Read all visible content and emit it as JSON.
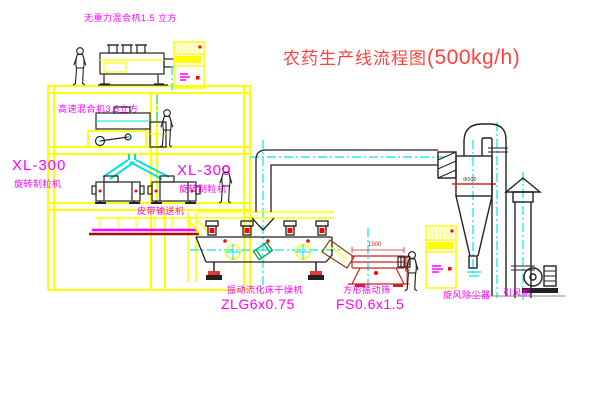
{
  "title": {
    "main": "农药生产线流程图",
    "capacity": "(500kg/h)"
  },
  "labels": {
    "gravity_mixer": "无重力混合机1.5 立方",
    "high_speed_mixer": "高速混合机3.5立方",
    "xl300_left": "XL-300",
    "granulator_left": "旋转制粒机",
    "xl300_right": "XL-300",
    "granulator_right": "旋转制粒机",
    "belt_conveyor": "皮带输送机",
    "dryer_name": "振动流化床干燥机",
    "dryer_model": "ZLG6x0.75",
    "sieve_name": "方形振动筛",
    "sieve_model": "FS0.6x1.5",
    "cyclone": "旋风除尘器",
    "fan": "引风机"
  },
  "dimensions": {
    "cyclone_diameter": "Φ500",
    "sieve_length": "1500",
    "sieve_height": "745"
  },
  "colors": {
    "structure_yellow": "#ffff00",
    "label_magenta": "#ff00ff",
    "title_red": "#ff4040",
    "centerline_cyan": "#00e5e5",
    "outline_black": "#222222",
    "accent_red": "#ff0000",
    "base_dark_red": "#991111",
    "motor_green": "#00a650"
  }
}
